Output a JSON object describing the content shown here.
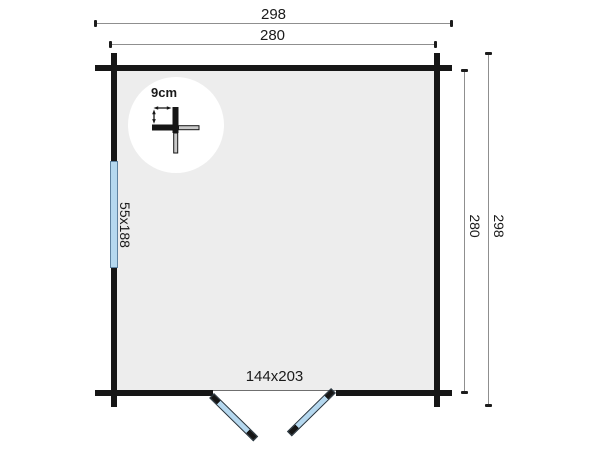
{
  "plan": {
    "title": "log-cabin-floor-plan",
    "dim_top_outer": "298",
    "dim_top_inner": "280",
    "dim_right_outer": "298",
    "dim_right_inner": "280",
    "window_label": "55x188",
    "door_label": "144x203",
    "detail_label": "9cm",
    "colors": {
      "wall": "#161616",
      "interior": "#ededed",
      "glazing_blue": "#b5d8ef",
      "dim_line": "#8f8f8f",
      "text": "#1a1a1a",
      "log_gray": "#c9c9c9"
    }
  }
}
